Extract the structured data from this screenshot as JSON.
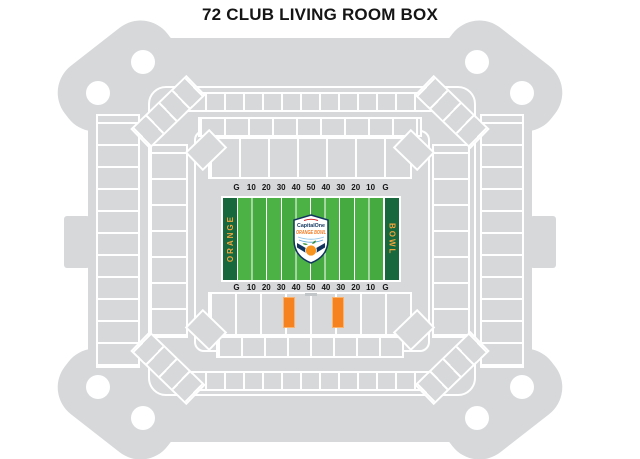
{
  "page": {
    "title": "72 CLUB LIVING ROOM BOX"
  },
  "field": {
    "yard_labels": [
      "G",
      "10",
      "20",
      "30",
      "40",
      "50",
      "40",
      "30",
      "20",
      "10",
      "G"
    ],
    "endzone_left": "ORANGE",
    "endzone_right": "BOWL",
    "logo": {
      "brand": "CapitalOne",
      "event": "ORANGE BOWL"
    }
  },
  "highlight": {
    "boxes": 2,
    "color": "#F5821F"
  },
  "colors": {
    "stadium_gray": "#D6D8DA",
    "section_line_white": "#FFFFFF",
    "field_green": "#4CB246",
    "field_green_alt": "#45AA40",
    "endzone_green": "#17693D",
    "endzone_text_orange": "#F2A33C",
    "highlight_orange": "#F5821F",
    "logo_navy": "#12355F",
    "logo_orange": "#F4791F",
    "title_black": "#151515"
  }
}
